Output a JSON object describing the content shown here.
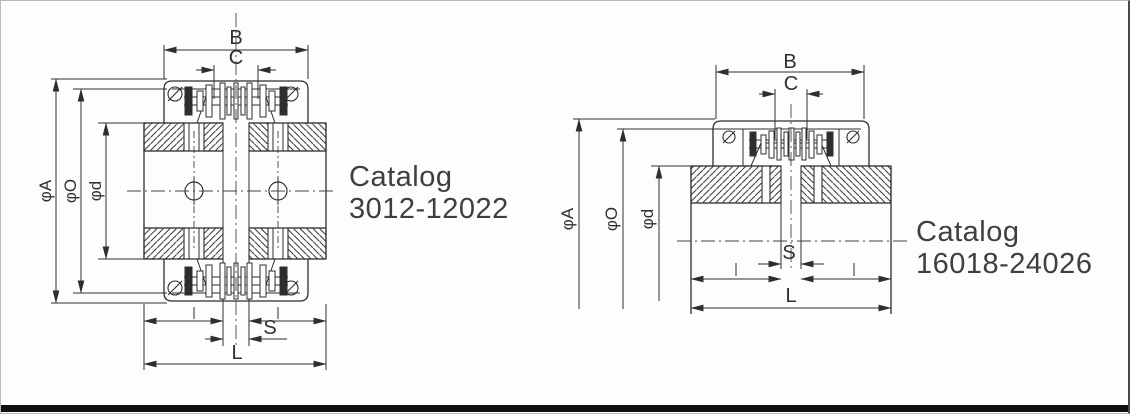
{
  "drawing": {
    "background": "#fdfdfd",
    "line_color": "#2e2e2e",
    "hatch_color": "#3a3a3a",
    "bottom_bar_color": "#101010"
  },
  "figures": {
    "left": {
      "catalog": {
        "line1": "Catalog",
        "line2": "3012-12022"
      },
      "dims": {
        "B": "B",
        "C": "C",
        "phiA": "φA",
        "phiO": "φO",
        "phiD": "φd",
        "S": "S",
        "L": "L"
      }
    },
    "right": {
      "catalog": {
        "line1": "Catalog",
        "line2": "16018-24026"
      },
      "dims": {
        "B": "B",
        "C": "C",
        "phiA": "φA",
        "phiO": "φO",
        "phiD": "φd",
        "S": "S",
        "L": "L"
      }
    }
  }
}
